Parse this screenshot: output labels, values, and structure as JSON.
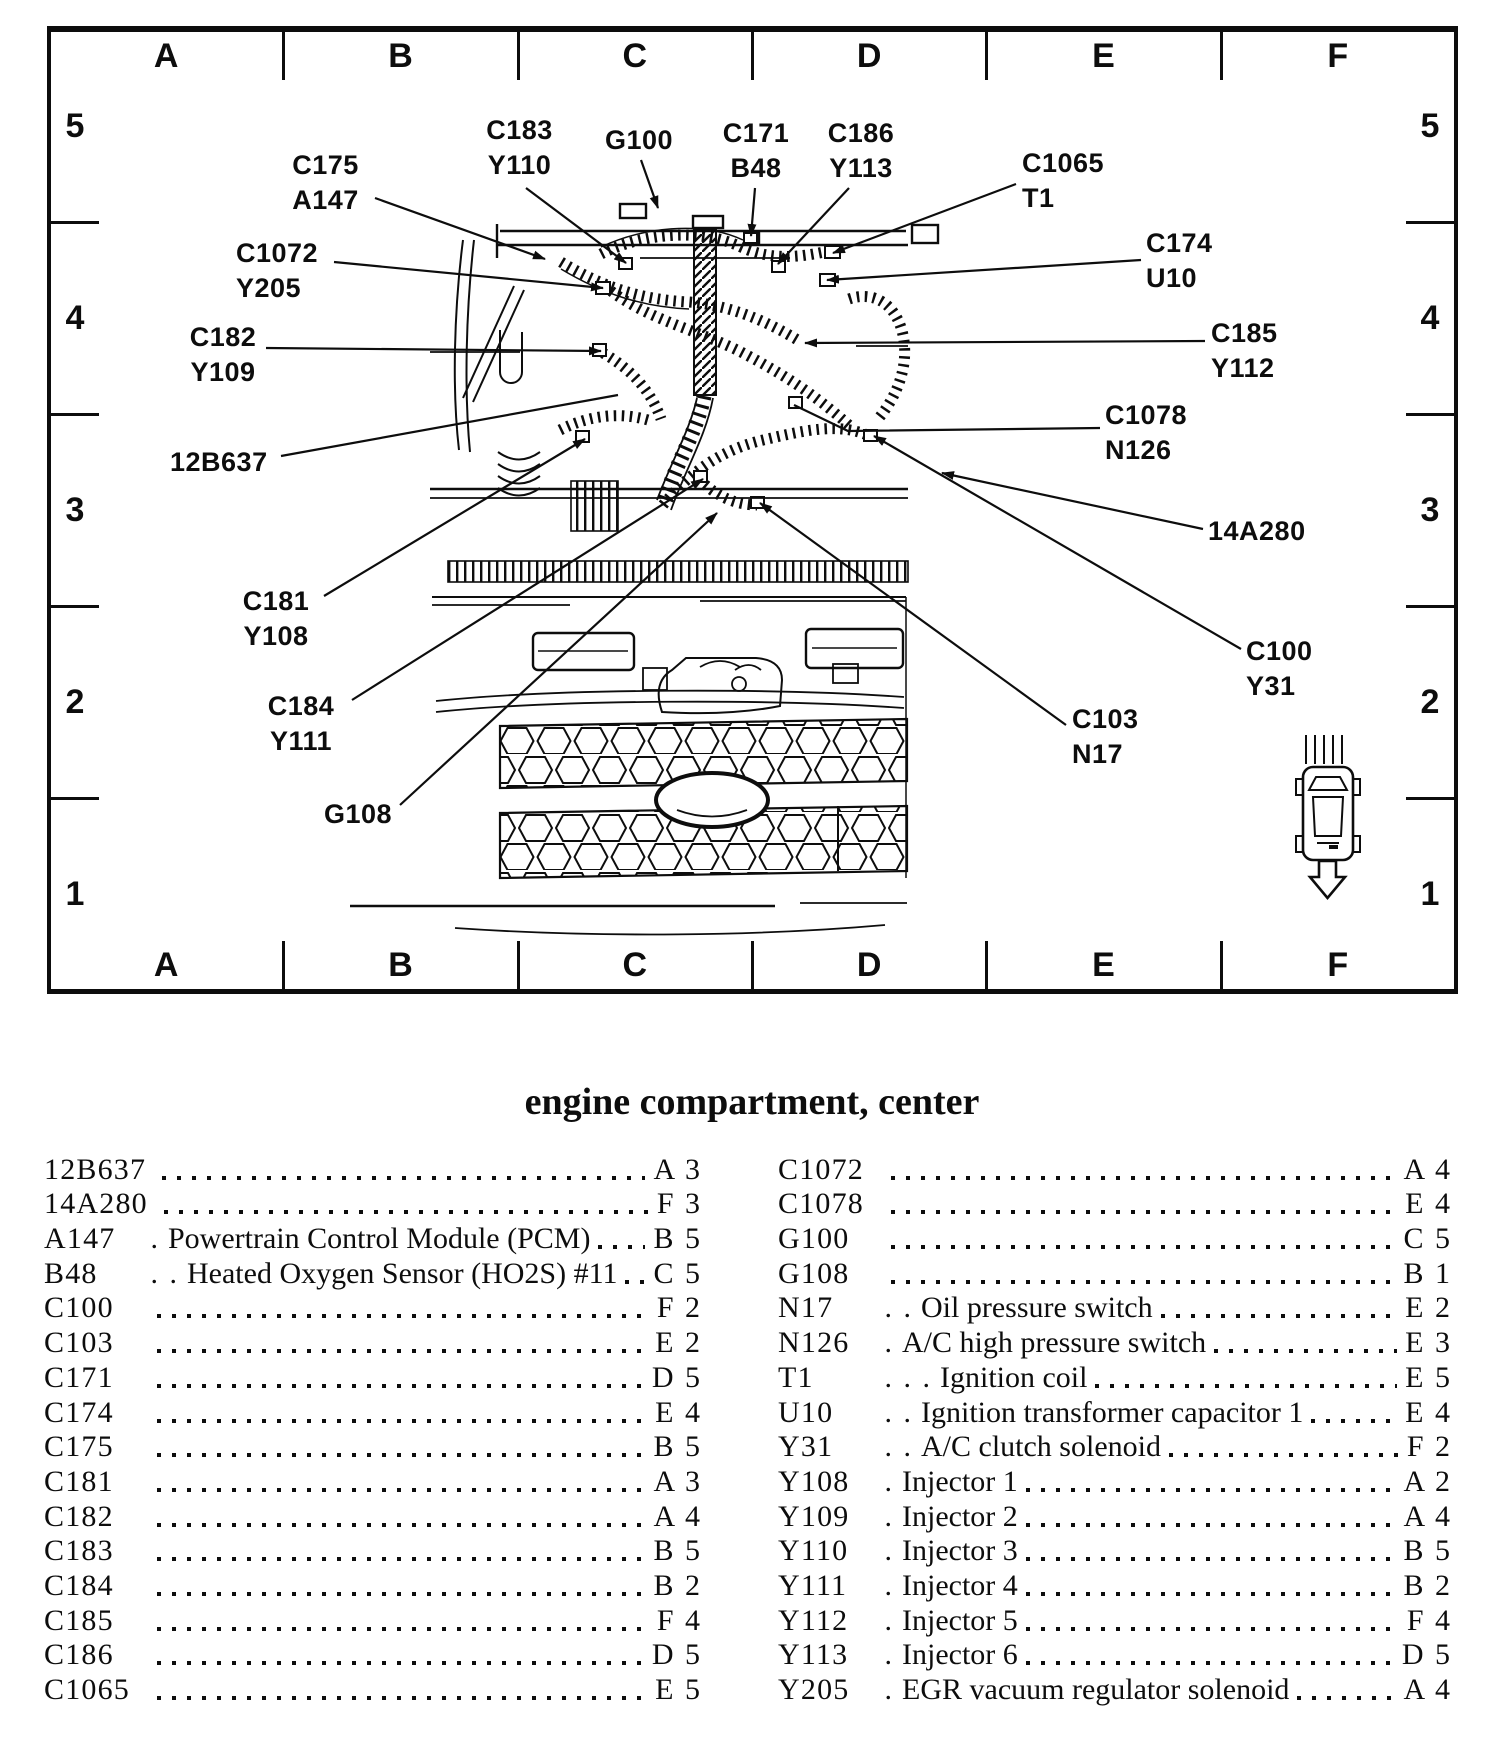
{
  "title": "engine compartment, center",
  "colors": {
    "ink": "#0d0d0d",
    "paper": "#ffffff"
  },
  "diagram": {
    "grid": {
      "columns": [
        "A",
        "B",
        "C",
        "D",
        "E",
        "F"
      ],
      "rows": [
        "5",
        "4",
        "3",
        "2",
        "1"
      ]
    },
    "vehicle_marker": {
      "icon": "car-top-view-icon",
      "arrow": "down-arrow-icon"
    },
    "callouts": [
      {
        "id": "C183",
        "lines": [
          "C183",
          "Y110"
        ],
        "x": 472,
        "y": 113,
        "w": 95,
        "align": "center"
      },
      {
        "id": "G100",
        "lines": [
          "G100"
        ],
        "x": 599,
        "y": 123,
        "w": 80,
        "align": "center"
      },
      {
        "id": "C171",
        "lines": [
          "C171",
          "B48"
        ],
        "x": 710,
        "y": 116,
        "w": 92,
        "align": "center"
      },
      {
        "id": "C186",
        "lines": [
          "C186",
          "Y113"
        ],
        "x": 815,
        "y": 116,
        "w": 92,
        "align": "center"
      },
      {
        "id": "C175",
        "lines": [
          "C175",
          "A147"
        ],
        "x": 278,
        "y": 148,
        "w": 95,
        "align": "center"
      },
      {
        "id": "C1065",
        "lines": [
          "C1065",
          "T1"
        ],
        "x": 1022,
        "y": 146,
        "w": 110,
        "align": "left"
      },
      {
        "id": "C1072",
        "lines": [
          "C1072",
          "Y205"
        ],
        "x": 236,
        "y": 236,
        "w": 95,
        "align": "left"
      },
      {
        "id": "C174",
        "lines": [
          "C174",
          "U10"
        ],
        "x": 1146,
        "y": 226,
        "w": 100,
        "align": "left"
      },
      {
        "id": "C182",
        "lines": [
          "C182",
          "Y109"
        ],
        "x": 183,
        "y": 320,
        "w": 80,
        "align": "center"
      },
      {
        "id": "C185",
        "lines": [
          "C185",
          "Y112"
        ],
        "x": 1211,
        "y": 316,
        "w": 95,
        "align": "left"
      },
      {
        "id": "C1078",
        "lines": [
          "C1078",
          "N126"
        ],
        "x": 1105,
        "y": 398,
        "w": 110,
        "align": "left"
      },
      {
        "id": "12B637",
        "lines": [
          "12B637"
        ],
        "x": 170,
        "y": 445,
        "w": 105,
        "align": "left"
      },
      {
        "id": "14A280",
        "lines": [
          "14A280"
        ],
        "x": 1208,
        "y": 514,
        "w": 115,
        "align": "left"
      },
      {
        "id": "C181",
        "lines": [
          "C181",
          "Y108"
        ],
        "x": 238,
        "y": 584,
        "w": 76,
        "align": "center"
      },
      {
        "id": "C100",
        "lines": [
          "C100",
          "Y31"
        ],
        "x": 1246,
        "y": 634,
        "w": 90,
        "align": "left"
      },
      {
        "id": "C184",
        "lines": [
          "C184",
          "Y111"
        ],
        "x": 263,
        "y": 689,
        "w": 76,
        "align": "center"
      },
      {
        "id": "C103",
        "lines": [
          "C103",
          "N17"
        ],
        "x": 1072,
        "y": 702,
        "w": 90,
        "align": "left"
      },
      {
        "id": "G108",
        "lines": [
          "G108"
        ],
        "x": 320,
        "y": 797,
        "w": 76,
        "align": "center"
      }
    ]
  },
  "index": {
    "left": [
      {
        "code": "12B637",
        "ref": "A 3"
      },
      {
        "code": "14A280",
        "ref": "F 3"
      },
      {
        "code": "A147",
        "lead": " .",
        "desc": "Powertrain Control Module (PCM)",
        "ref": "B 5"
      },
      {
        "code": "B48",
        "lead": " . .",
        "desc": "Heated Oxygen Sensor (HO2S) #11",
        "ref": "C 5"
      },
      {
        "code": "C100",
        "ref": "F 2"
      },
      {
        "code": "C103",
        "ref": "E 2"
      },
      {
        "code": "C171",
        "ref": "D 5"
      },
      {
        "code": "C174",
        "ref": "E 4"
      },
      {
        "code": "C175",
        "ref": "B 5"
      },
      {
        "code": "C181",
        "ref": "A 3"
      },
      {
        "code": "C182",
        "ref": "A 4"
      },
      {
        "code": "C183",
        "ref": "B 5"
      },
      {
        "code": "C184",
        "ref": "B 2"
      },
      {
        "code": "C185",
        "ref": "F 4"
      },
      {
        "code": "C186",
        "ref": "D 5"
      },
      {
        "code": "C1065",
        "ref": "E 5"
      }
    ],
    "right": [
      {
        "code": "C1072",
        "ref": "A 4"
      },
      {
        "code": "C1078",
        "ref": "E 4"
      },
      {
        "code": "G100",
        "ref": "C 5"
      },
      {
        "code": "G108",
        "ref": "B 1"
      },
      {
        "code": "N17",
        "lead": " . .",
        "desc": "Oil pressure switch",
        "ref": "E 2"
      },
      {
        "code": "N126",
        "lead": " .",
        "desc": "A/C high pressure switch",
        "ref": "E 3"
      },
      {
        "code": "T1",
        "lead": " . . .",
        "desc": "Ignition coil",
        "ref": "E 5"
      },
      {
        "code": "U10",
        "lead": " . .",
        "desc": "Ignition transformer capacitor 1",
        "ref": "E 4"
      },
      {
        "code": "Y31",
        "lead": " . .",
        "desc": "A/C clutch solenoid",
        "ref": "F 2"
      },
      {
        "code": "Y108",
        "lead": " .",
        "desc": "Injector 1",
        "ref": "A 2"
      },
      {
        "code": "Y109",
        "lead": " .",
        "desc": "Injector 2",
        "ref": "A 4"
      },
      {
        "code": "Y110",
        "lead": " .",
        "desc": "Injector 3",
        "ref": "B 5"
      },
      {
        "code": "Y111",
        "lead": " .",
        "desc": "Injector 4",
        "ref": "B 2"
      },
      {
        "code": "Y112",
        "lead": " .",
        "desc": "Injector 5",
        "ref": "F 4"
      },
      {
        "code": "Y113",
        "lead": " .",
        "desc": "Injector 6",
        "ref": "D 5"
      },
      {
        "code": "Y205",
        "lead": " .",
        "desc": "EGR vacuum regulator solenoid",
        "ref": "A 4"
      }
    ]
  }
}
